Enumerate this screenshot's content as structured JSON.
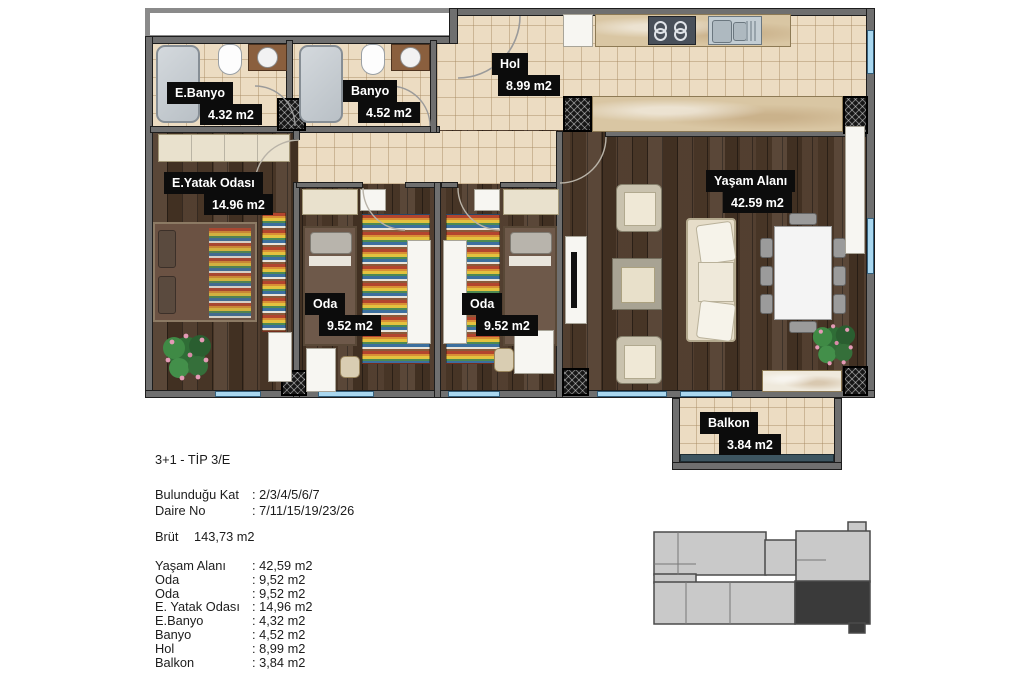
{
  "plan": {
    "room_labels": {
      "ebanyo": {
        "name": "E.Banyo",
        "area": "4.32 m2"
      },
      "banyo": {
        "name": "Banyo",
        "area": "4.52 m2"
      },
      "hol": {
        "name": "Hol",
        "area": "8.99 m2"
      },
      "eyatak": {
        "name": "E.Yatak Odası",
        "area": "14.96 m2"
      },
      "oda1": {
        "name": "Oda",
        "area": "9.52 m2"
      },
      "oda2": {
        "name": "Oda",
        "area": "9.52 m2"
      },
      "yasam": {
        "name": "Yaşam Alanı",
        "area": "42.59 m2"
      },
      "balkon": {
        "name": "Balkon",
        "area": "3.84 m2"
      }
    }
  },
  "info": {
    "type_title": "3+1 - TİP 3/E",
    "rows": [
      {
        "label": "Bulunduğu Kat",
        "value": ": 2/3/4/5/6/7"
      },
      {
        "label": "Daire No",
        "value": ": 7/11/15/19/23/26"
      }
    ],
    "gross_label": "Brüt",
    "gross_value": "143,73 m2",
    "room_list": [
      {
        "name": "Yaşam Alanı",
        "value": ": 42,59 m2"
      },
      {
        "name": "Oda",
        "value": ": 9,52 m2"
      },
      {
        "name": "Oda",
        "value": ": 9,52 m2"
      },
      {
        "name": "E. Yatak Odası",
        "value": ": 14,96 m2"
      },
      {
        "name": "E.Banyo",
        "value": ": 4,32 m2"
      },
      {
        "name": "Banyo",
        "value": ": 4,52 m2"
      },
      {
        "name": "Hol",
        "value": ": 8,99 m2"
      },
      {
        "name": "Balkon",
        "value": ": 3,84 m2"
      }
    ]
  },
  "colors": {
    "label_bg": "#0c0c0c",
    "label_text": "#ffffff",
    "wall": "#6f6f6f",
    "wood_floor": "#4d3929",
    "tile_floor": "#ecdcc2",
    "window_glass": "#a9d7ef",
    "keyplan_light": "#c9c9c9",
    "keyplan_dark": "#3a3a3a"
  }
}
